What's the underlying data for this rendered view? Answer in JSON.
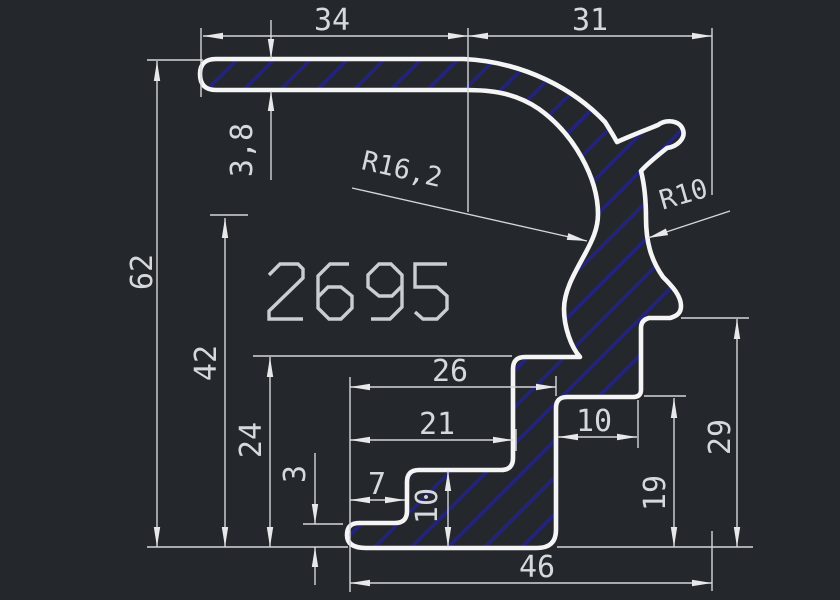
{
  "drawing": {
    "title_label": "2695",
    "colors": {
      "background": "#24282d",
      "outline": "#f5f5f5",
      "hatch": "#23237d",
      "dimension": "#d6d9dc",
      "big_label": "#c9ced5"
    },
    "dimensions": {
      "top_flange_length": "34",
      "top_curve_length": "31",
      "flange_thickness": "3,8",
      "total_height": "62",
      "mid_height": "42",
      "lower_height": "24",
      "foot_thickness": "3",
      "foot_notch_width": "7",
      "lower_width_outer": "26",
      "lower_width_inner": "21",
      "step_width": "10",
      "foot_height": "10",
      "step_height": "19",
      "right_height": "29",
      "bottom_width": "46",
      "radius_large": "R16,2",
      "radius_small": "R10"
    }
  }
}
